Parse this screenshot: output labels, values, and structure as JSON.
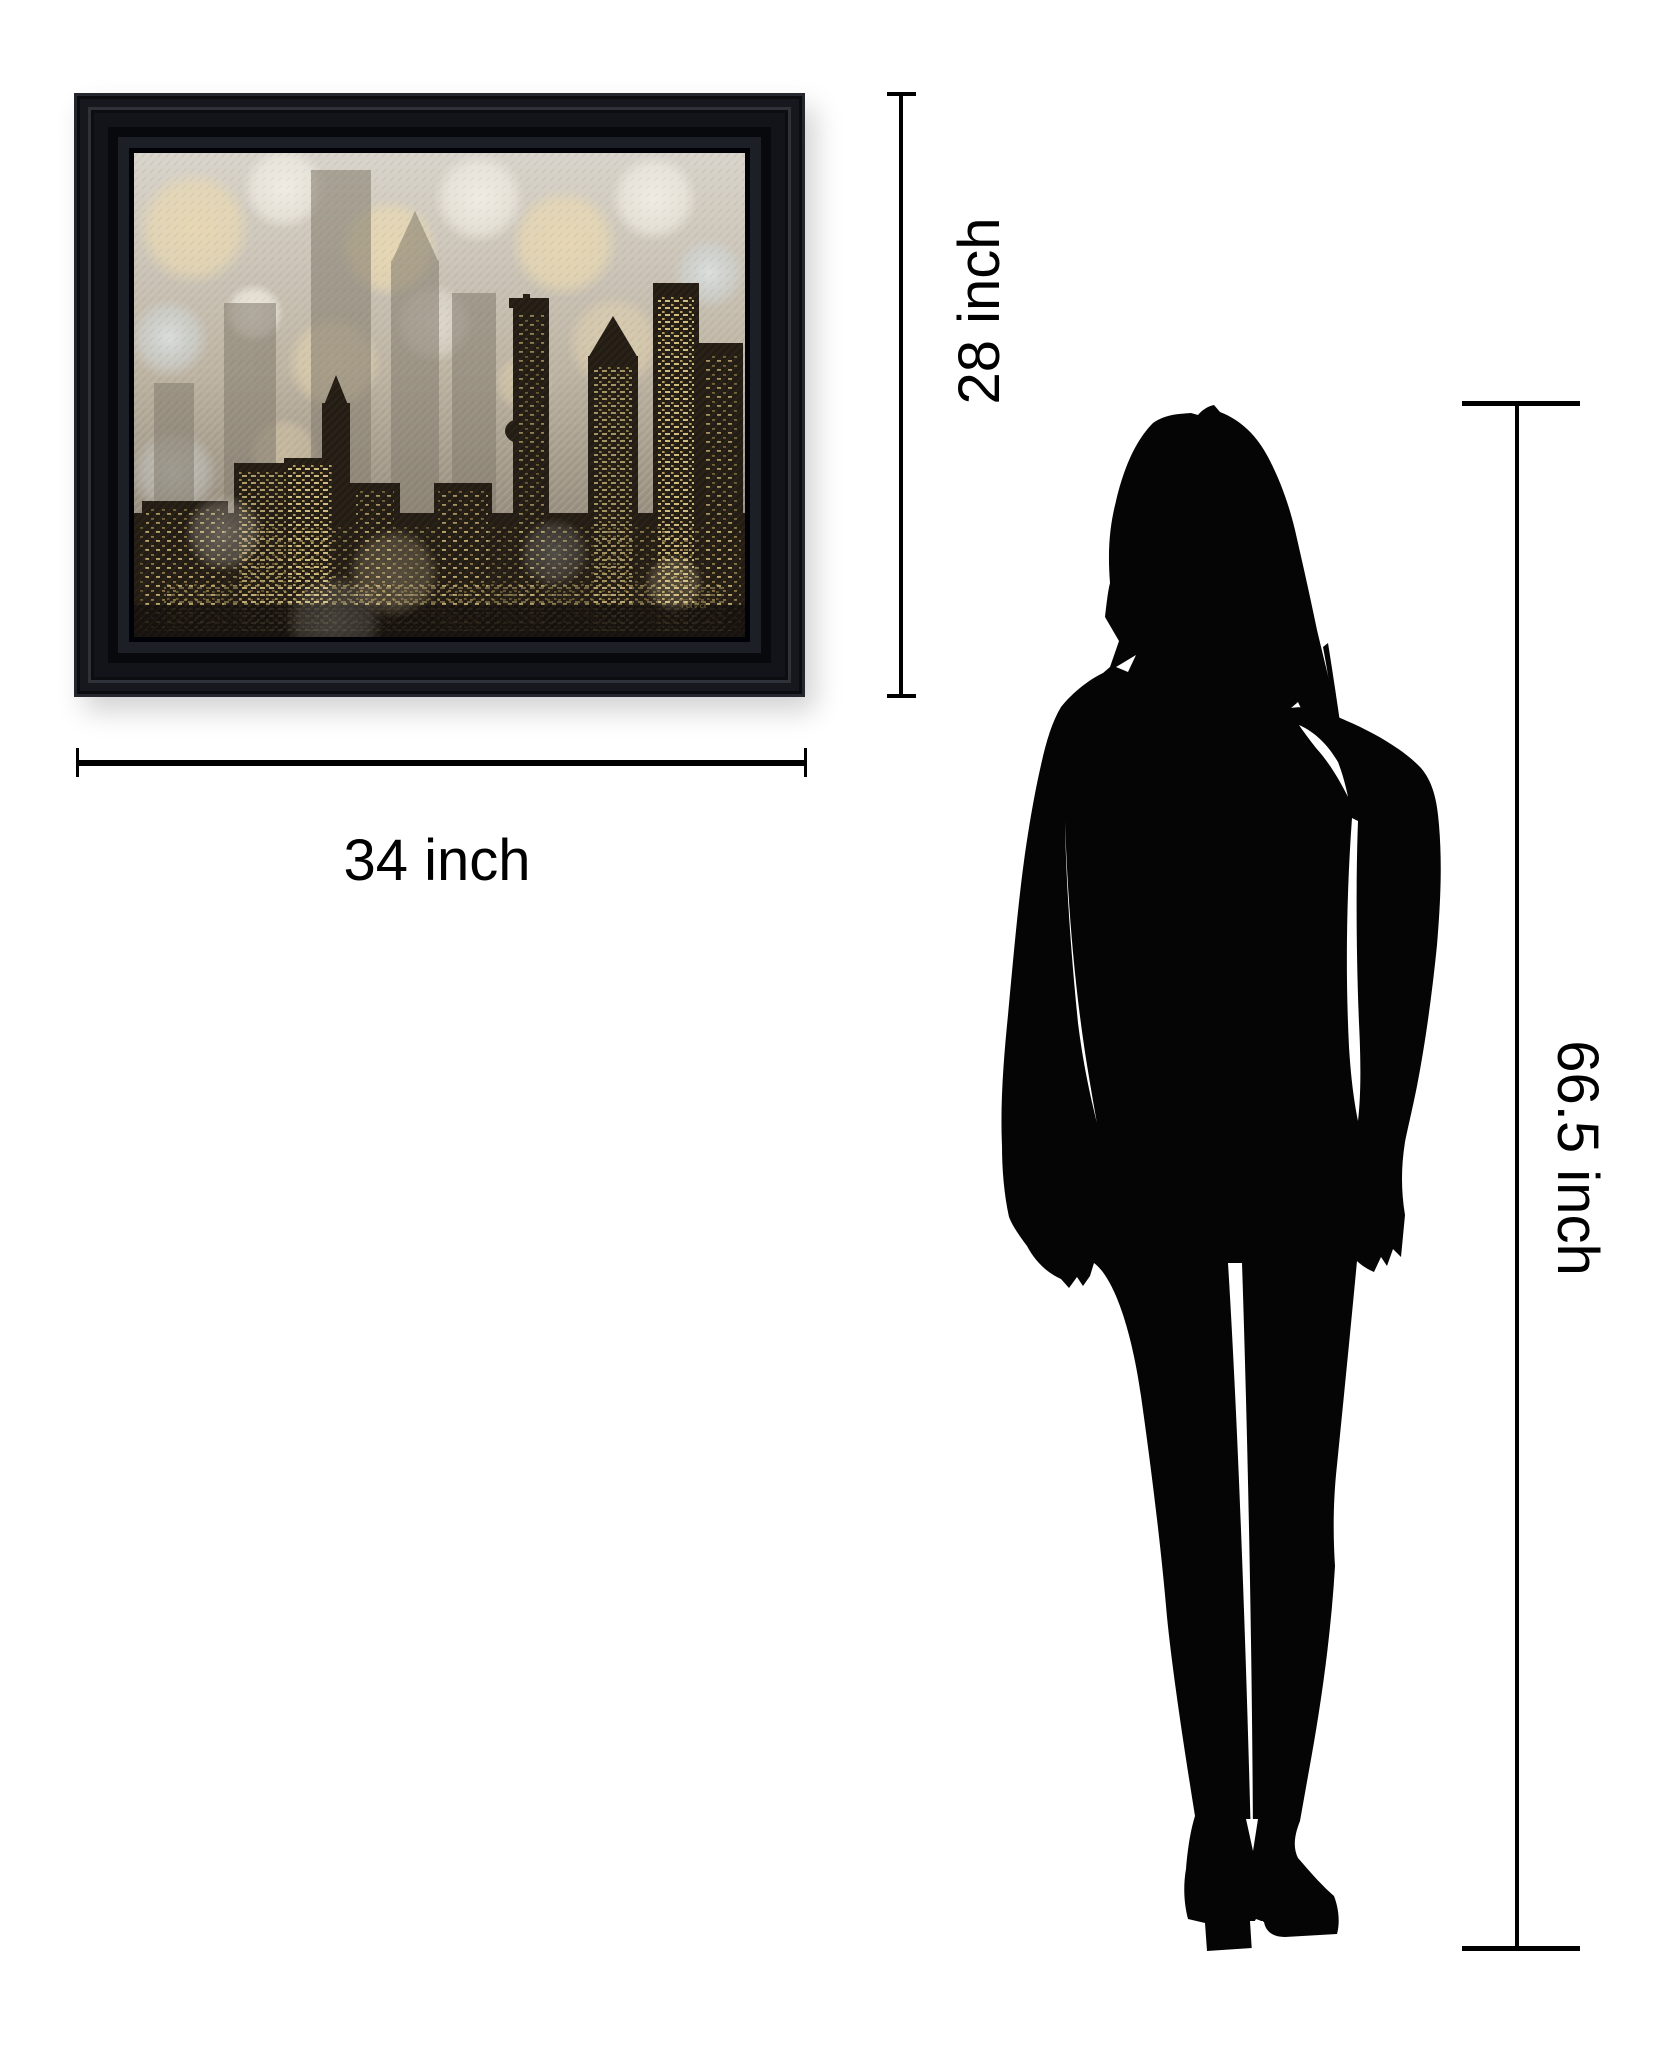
{
  "page": {
    "background": "#ffffff"
  },
  "artwork": {
    "name": "framed city skyline bokeh art print",
    "frame_color": "#0b0d11",
    "signature": "Tava",
    "palette": {
      "canvas_light": "#d8d3ca",
      "canvas_mid": "#b5aa98",
      "canvas_deep": "#6e6559",
      "bokeh_cream": "#ead9b0",
      "bokeh_white": "#f3efe6",
      "bokeh_steel": "#cfd6d8",
      "building_back": "#857d6f",
      "building_dark": "#241d14",
      "window_gold": "#e3cd8a"
    }
  },
  "dimensions": {
    "width": {
      "label": "34 inch"
    },
    "height": {
      "label": "28 inch"
    },
    "person_height": {
      "label": "66.5 inch"
    },
    "line_color": "#000000"
  },
  "person": {
    "name": "woman silhouette",
    "color": "#050505"
  }
}
